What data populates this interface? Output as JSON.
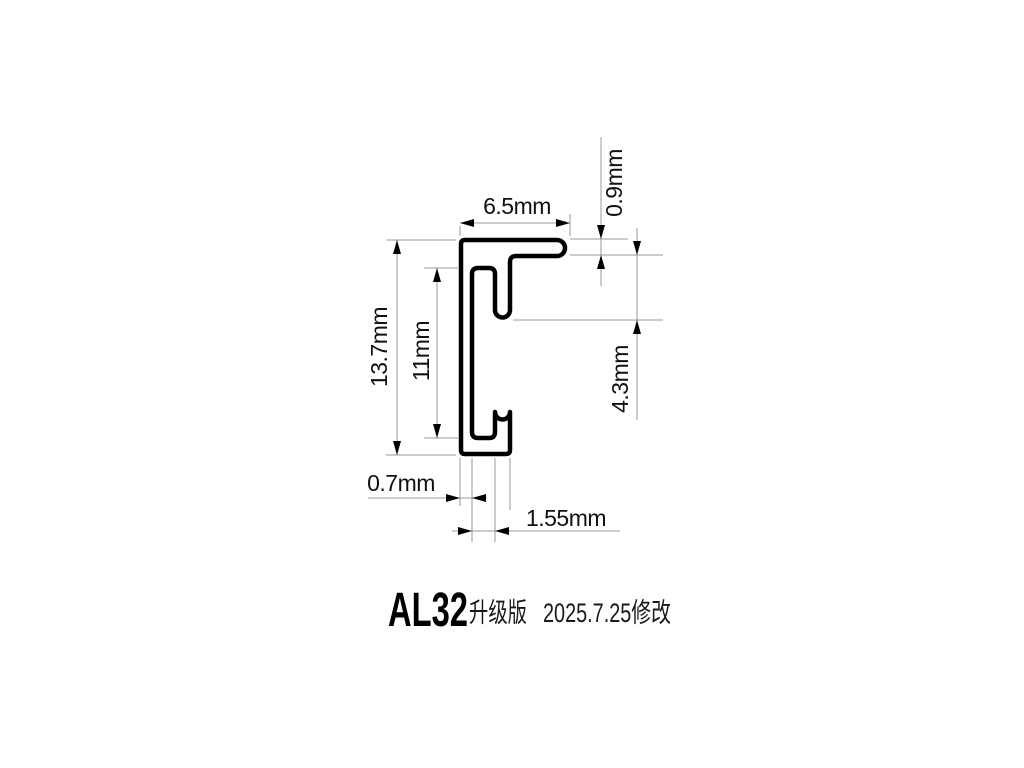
{
  "title": {
    "model": "AL32",
    "edition": "升级版",
    "revision": "2025.7.25修改"
  },
  "dimensions": {
    "top_width": "6.5mm",
    "flange_thickness": "0.9mm",
    "overall_height": "13.7mm",
    "inner_height": "11mm",
    "hook_depth": "4.3mm",
    "wall_thickness": "0.7mm",
    "slot_width": "1.55mm"
  },
  "colors": {
    "background": "#ffffff",
    "profile_outline": "#000000",
    "dimension_lines": "#9a9a9a",
    "text": "#111111"
  }
}
